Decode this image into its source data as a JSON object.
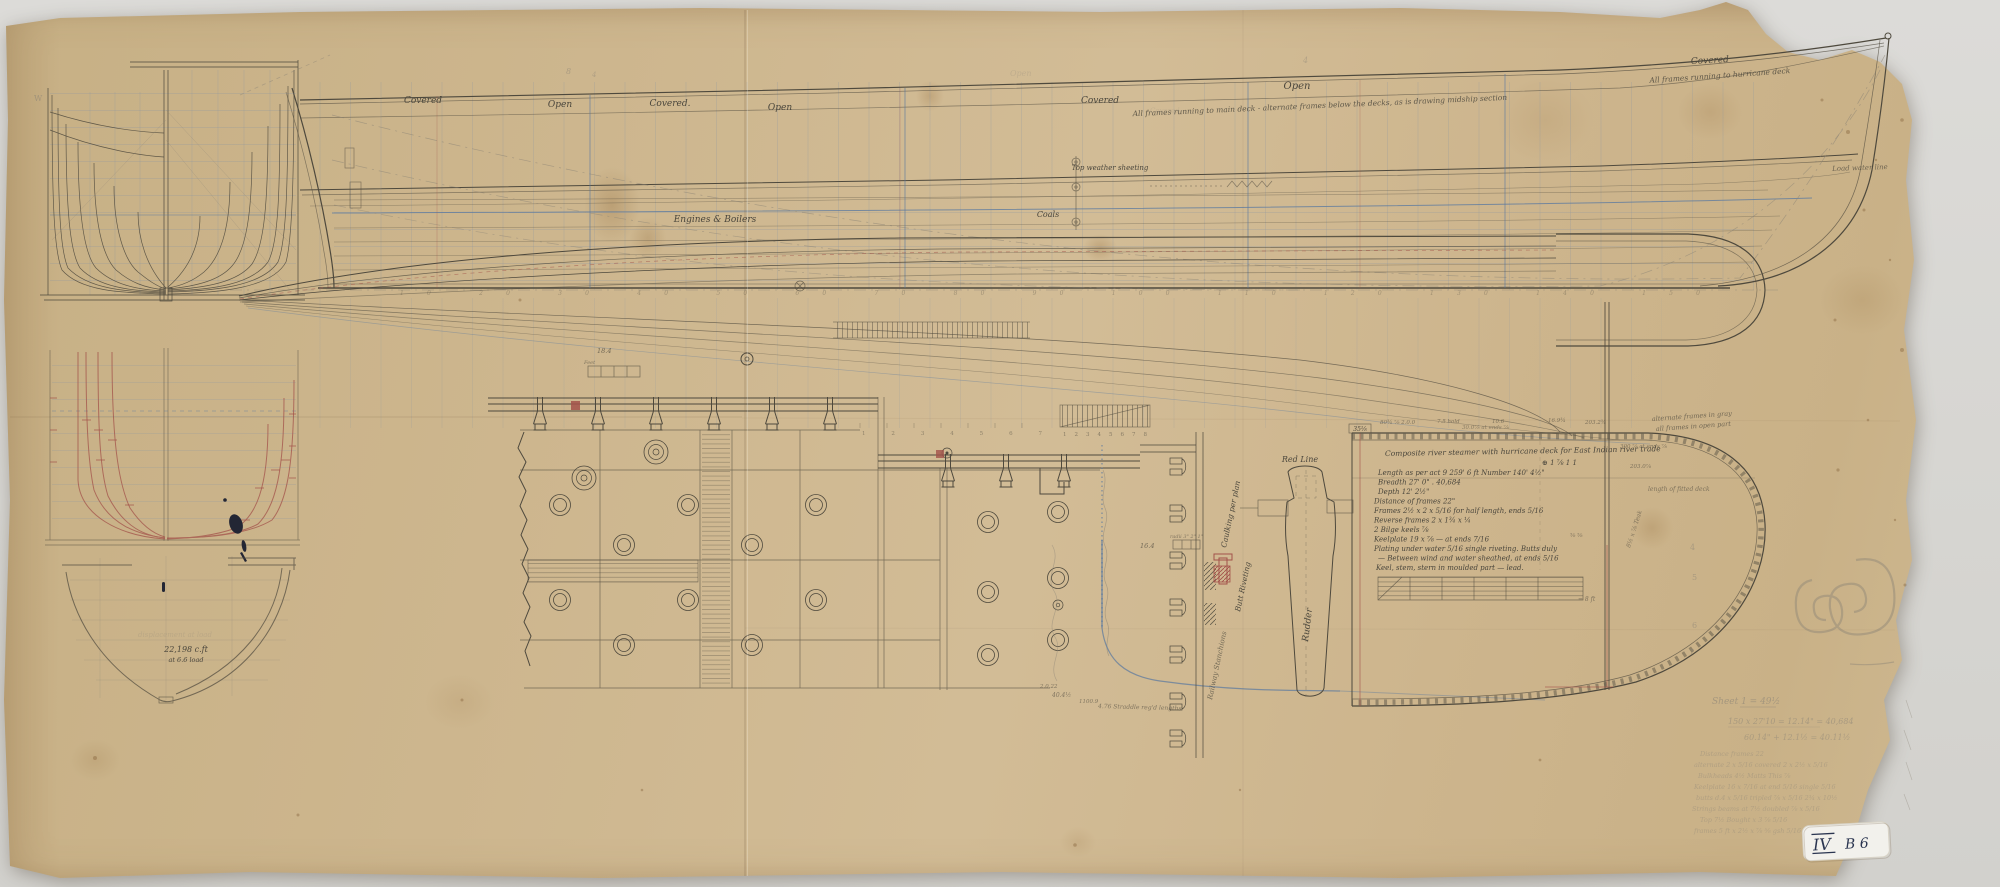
{
  "colors": {
    "paper": "#cdb68e",
    "ink": "#4a463c",
    "red_ink": "#a3524a",
    "blue_ink": "#5878a0",
    "grid_blue": "#8b95a0",
    "pencil": "#8d8577",
    "backdrop": "#d8d7d3",
    "sticker_bg": "#f2f1ec",
    "sticker_ink": "#2a3550"
  },
  "sheer_plan": {
    "deck_zone_labels": [
      "Covered",
      "Open",
      "Covered.",
      "Open",
      "Covered",
      "Open",
      "Covered"
    ],
    "frames_note_main": "All frames running to main deck - alternate frames below the decks, as is drawing midship section",
    "frames_note_hurricane": "All frames running to hurricane deck",
    "engines_label": "Engines & Boilers",
    "coals_label": "Coals",
    "sheeting_label": "Top weather sheeting",
    "waterline_label": "Load water line"
  },
  "station_numbers": "10   20   30   40   50   60   70   80   90   100   110   120   130   140   150",
  "body_plans": {
    "w_mark": "W",
    "volume_note": "22,198 c.ft",
    "load_note": "at 6.6 load",
    "ghost_note": "displacement at load"
  },
  "stern_plan": {
    "spec_title": "Composite river steamer with hurricane deck for East Indian river trade",
    "spec_mark": "⊕ 1 ⅞ 1 1",
    "spec_lines": [
      "Length as per act 9    259' 6 ft        Number 140' 4½\"",
      "    Breadth                 27' 0\"            .  40,684",
      "    Depth                   12' 2½\"",
      "Distance of frames 22\"",
      "Frames 2½ x 2 x 5/16 for half length, ends 5/16",
      "Reverse frames 2 x 1¾ x ¼",
      "2 Bilge keels ⅞",
      "Keelplate 19 x ⅞ — at ends 7/16",
      "Plating under water 5/16 single riveting. Butts duly",
      "— Between wind and water sheathed, at ends 5/16",
      "Keel, stem, stern in moulded part — lead."
    ],
    "corner_box_label": "35⅛",
    "top_dims": [
      "80¾ ⅞ 2.0.0",
      "7.5 hold",
      "10.6",
      "16.9¾",
      "203.2¾"
    ],
    "under_dim": "30.0⅞ at ends ⅞",
    "side_note_1": "alternate frames in gray",
    "side_note_2": "all frames in open part",
    "side_note_3": "300 ⅞ at ends ⅞",
    "side_note_4": "203.0⅞",
    "side_note_5": "⅝ ⅝",
    "side_note_6": "= 8 ft",
    "length_note": "length of fitted deck",
    "teak_note": "8½ x ⅞ Teak",
    "station_digits": [
      "4",
      "5",
      "6",
      "7"
    ],
    "bottom_notes": [
      "2.0.22",
      "40.4½",
      "1100.9",
      "4.76 Straddle reg'd lengths"
    ]
  },
  "details": {
    "red_line_label": "Red Line",
    "rudder_label": "Rudder",
    "caulking_label": "Caulking per plan",
    "butt_label": "Butt Riveting",
    "stanchion_label": "Railway Stanchions",
    "radii_label": "radii 3\" 2\" 1\"",
    "feet_label": "Feet",
    "dim_18": "18.4",
    "dim_16": "16.4",
    "scale_digits_1": "1  2  3  4  5  6  7",
    "scale_digits_2": "1 2 3 4 5 6 7 8"
  },
  "pencil_notes": {
    "top_mark_1": "8",
    "top_mark_2": "4",
    "top_mark_3": "4",
    "sheet_note": "Sheet 1 = 49½",
    "calc_1": "150 x 27'10 = 12.14\" = 40,684",
    "calc_2": "60.14\" + 12.1½ = 40.11½",
    "memo_lines": [
      "Distance frames 22",
      "alternate 2 x 5/16   covered 2 x 2½ x 5/16",
      "Bulkheads 4½      Matts This ⅞",
      "Keelplate 16 x 7/16 at end 5/16 single 5/16",
      "butts d.4 x 5/16 tripled ⅞ x 5/16  2¾ x 10½",
      "Strings beams at 7½   doubled ⅞ x 5/16",
      "Top 7½        Bought x 3 ⅞ 5/16",
      "frames 5 ft x 2½ x ⅞ ⅝ gsh 5/16"
    ],
    "corner_mark": "3"
  },
  "archive_label": {
    "roman": "IV",
    "rest": "B 6"
  }
}
